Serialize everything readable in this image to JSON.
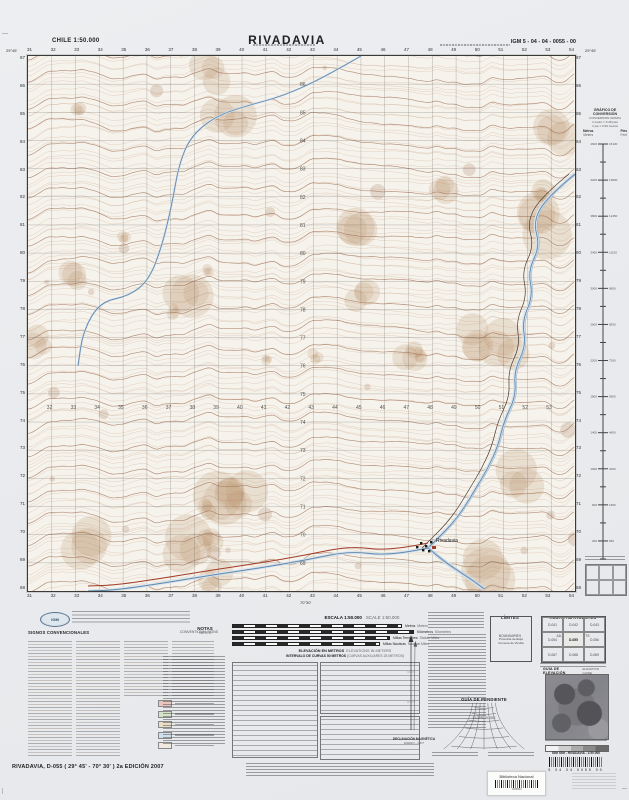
{
  "header": {
    "left": "CHILE  1:50.000",
    "title": "RIVADAVIA",
    "right": "IGM 5 - 04 - 04 - 0055 - 00"
  },
  "corners": {
    "top_left": "29°45'",
    "top_right": "29°45'",
    "bottom_center": "70°30'"
  },
  "map": {
    "town_label": "Rivadavia",
    "grid": {
      "eastings": [
        "31",
        "32",
        "33",
        "34",
        "35",
        "36",
        "37",
        "38",
        "39",
        "40",
        "41",
        "42",
        "43",
        "44",
        "45",
        "46",
        "47",
        "48",
        "49",
        "50",
        "51",
        "52",
        "53",
        "54"
      ],
      "northings": [
        "87",
        "86",
        "85",
        "84",
        "83",
        "82",
        "81",
        "80",
        "79",
        "78",
        "77",
        "76",
        "75",
        "74",
        "73",
        "72",
        "71",
        "70",
        "69",
        "68"
      ]
    },
    "features": {
      "east_river": [
        [
          547,
          118
        ],
        [
          520,
          140
        ],
        [
          505,
          165
        ],
        [
          512,
          190
        ],
        [
          500,
          215
        ],
        [
          505,
          240
        ],
        [
          494,
          265
        ],
        [
          498,
          290
        ],
        [
          486,
          315
        ],
        [
          488,
          340
        ],
        [
          476,
          365
        ],
        [
          470,
          390
        ],
        [
          460,
          412
        ],
        [
          448,
          432
        ],
        [
          436,
          452
        ],
        [
          424,
          468
        ],
        [
          410,
          482
        ],
        [
          400,
          492
        ]
      ],
      "east_lower": [
        [
          400,
          492
        ],
        [
          414,
          504
        ],
        [
          430,
          515
        ],
        [
          444,
          524
        ],
        [
          456,
          533
        ]
      ],
      "west_branch": [
        [
          400,
          492
        ],
        [
          362,
          500
        ],
        [
          322,
          495
        ],
        [
          278,
          504
        ],
        [
          232,
          512
        ],
        [
          184,
          519
        ],
        [
          136,
          527
        ],
        [
          88,
          534
        ],
        [
          60,
          535
        ]
      ],
      "nw_stream": [
        [
          333,
          0
        ],
        [
          295,
          22
        ],
        [
          255,
          40
        ],
        [
          218,
          50
        ],
        [
          188,
          60
        ],
        [
          163,
          80
        ],
        [
          151,
          108
        ],
        [
          144,
          148
        ],
        [
          134,
          190
        ],
        [
          121,
          224
        ],
        [
          101,
          240
        ],
        [
          72,
          246
        ],
        [
          55,
          275
        ],
        [
          50,
          310
        ]
      ]
    },
    "colors": {
      "contour": "#b98d6e",
      "contour_index": "#9c6b4d",
      "water": "#5f88ae",
      "water_fill": "#d7e2eb",
      "road": "#4a3a2e",
      "road_red": "#a23c28",
      "grid": "rgba(80,75,70,0.5)"
    }
  },
  "conversion": {
    "title": "GRÁFICO DE CONVERSIÓN",
    "subtitle": "CONVERSION GRAPH",
    "eq1": "1 metro = 3.28 pies",
    "eq2": "1 pie = 0.30 metros",
    "units_left": "Metros",
    "units_left_en": "Meters",
    "units_right": "Pies",
    "units_right_en": "Feet",
    "scale": {
      "max_m": 4600,
      "step_m": 200
    }
  },
  "publisher": {
    "logo": "IGM"
  },
  "legend": {
    "title": "SIGNOS CONVENCIONALES",
    "subtitle": "CONVENTIONAL SIGNS"
  },
  "notes": {
    "es": "NOTAS",
    "en": "NOTES"
  },
  "scalebar": {
    "title_es": "ESCALA 1:50.000",
    "title_en": "SCALE 1:50.000",
    "rows": [
      {
        "es": "Metros",
        "en": "Meters"
      },
      {
        "es": "Kilómetros",
        "en": "Kilometers"
      },
      {
        "es": "Millas Terrestres",
        "en": "Statute Miles"
      },
      {
        "es": "Millas Náuticas",
        "en": "Nautical Miles"
      }
    ]
  },
  "elevation": {
    "es": "ELEVACIÓN EN METROS",
    "en": "ELEVATIONS IN METERS",
    "interval": "INTERVALO DE CURVAS 50 METROS",
    "aux": "(CURVAS AUXILIARES 25 METROS)"
  },
  "limits": {
    "title": "LÍMITES",
    "subtitle": "BOUNDARIES",
    "line1": "Provincia de Elqui",
    "line2": "Comuna de Vicuña"
  },
  "adjoining": {
    "title": "HOJAS ADYACENTES",
    "subtitle": "ADJOINING SHEETS",
    "sheets": [
      "D-041",
      "D-042",
      "D-043",
      "D-054",
      "D-055",
      "D-056",
      "D-067",
      "D-068",
      "D-069"
    ]
  },
  "declination": {
    "title": "DECLINACIÓN MAGNÉTICA",
    "date": "ENERO - 2007"
  },
  "slope": {
    "title": "GUÍA DE PENDIENTE",
    "subtitle": "SLOPE GUIDE"
  },
  "elev_guide": {
    "title": "GUÍA DE ELEVACIÓN",
    "subtitle": "ELEVATION GUIDE",
    "caption": "IGM - RIVADAVIA - 1:50.000",
    "digits": "5   04   04   0055   00"
  },
  "library": {
    "label": "Biblioteca Nacional",
    "number": "1095820"
  },
  "footer": {
    "title": "RIVADAVIA, D-055 ( 29° 45' - 70° 30' ) 2a EDICIÓN 2007"
  }
}
